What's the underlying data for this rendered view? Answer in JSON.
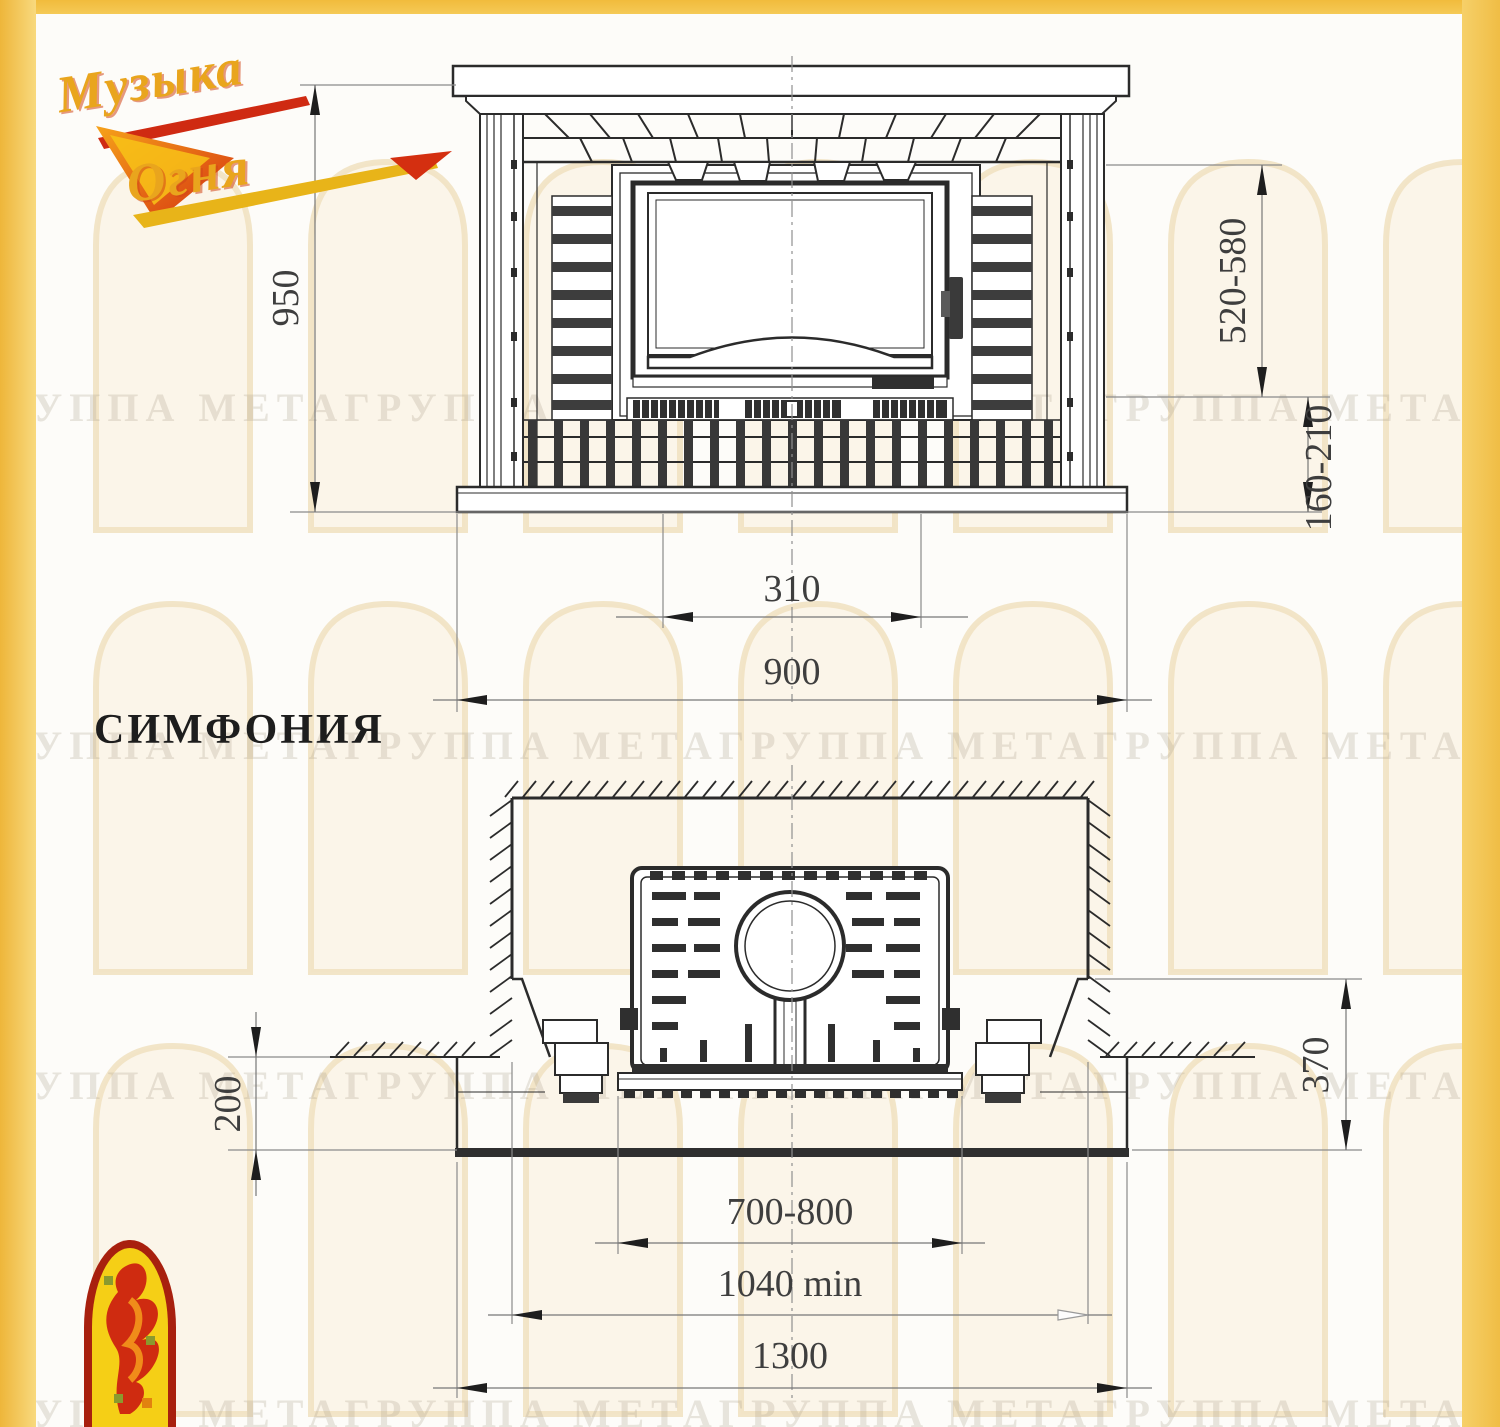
{
  "brand": {
    "logo_word1": "Музыка",
    "logo_word2": "Огня"
  },
  "title": {
    "model_name": "СИМФОНИЯ"
  },
  "watermark": {
    "row_text": "ГРУППА МЕТАГРУППА МЕТАГРУППА МЕТАГРУППА МЕТА ГРУППА"
  },
  "front_view": {
    "dims": {
      "overall_height": "950",
      "firebox_opening_height": "520-580",
      "plinth_height": "160-210",
      "grate_width": "310",
      "base_width": "900"
    }
  },
  "plan_view": {
    "dims": {
      "hearth_protrusion_depth": "200",
      "portal_front_depth": "370",
      "opening_width": "700-800",
      "niche_width_min": "1040 min",
      "hearth_width": "1300"
    }
  }
}
